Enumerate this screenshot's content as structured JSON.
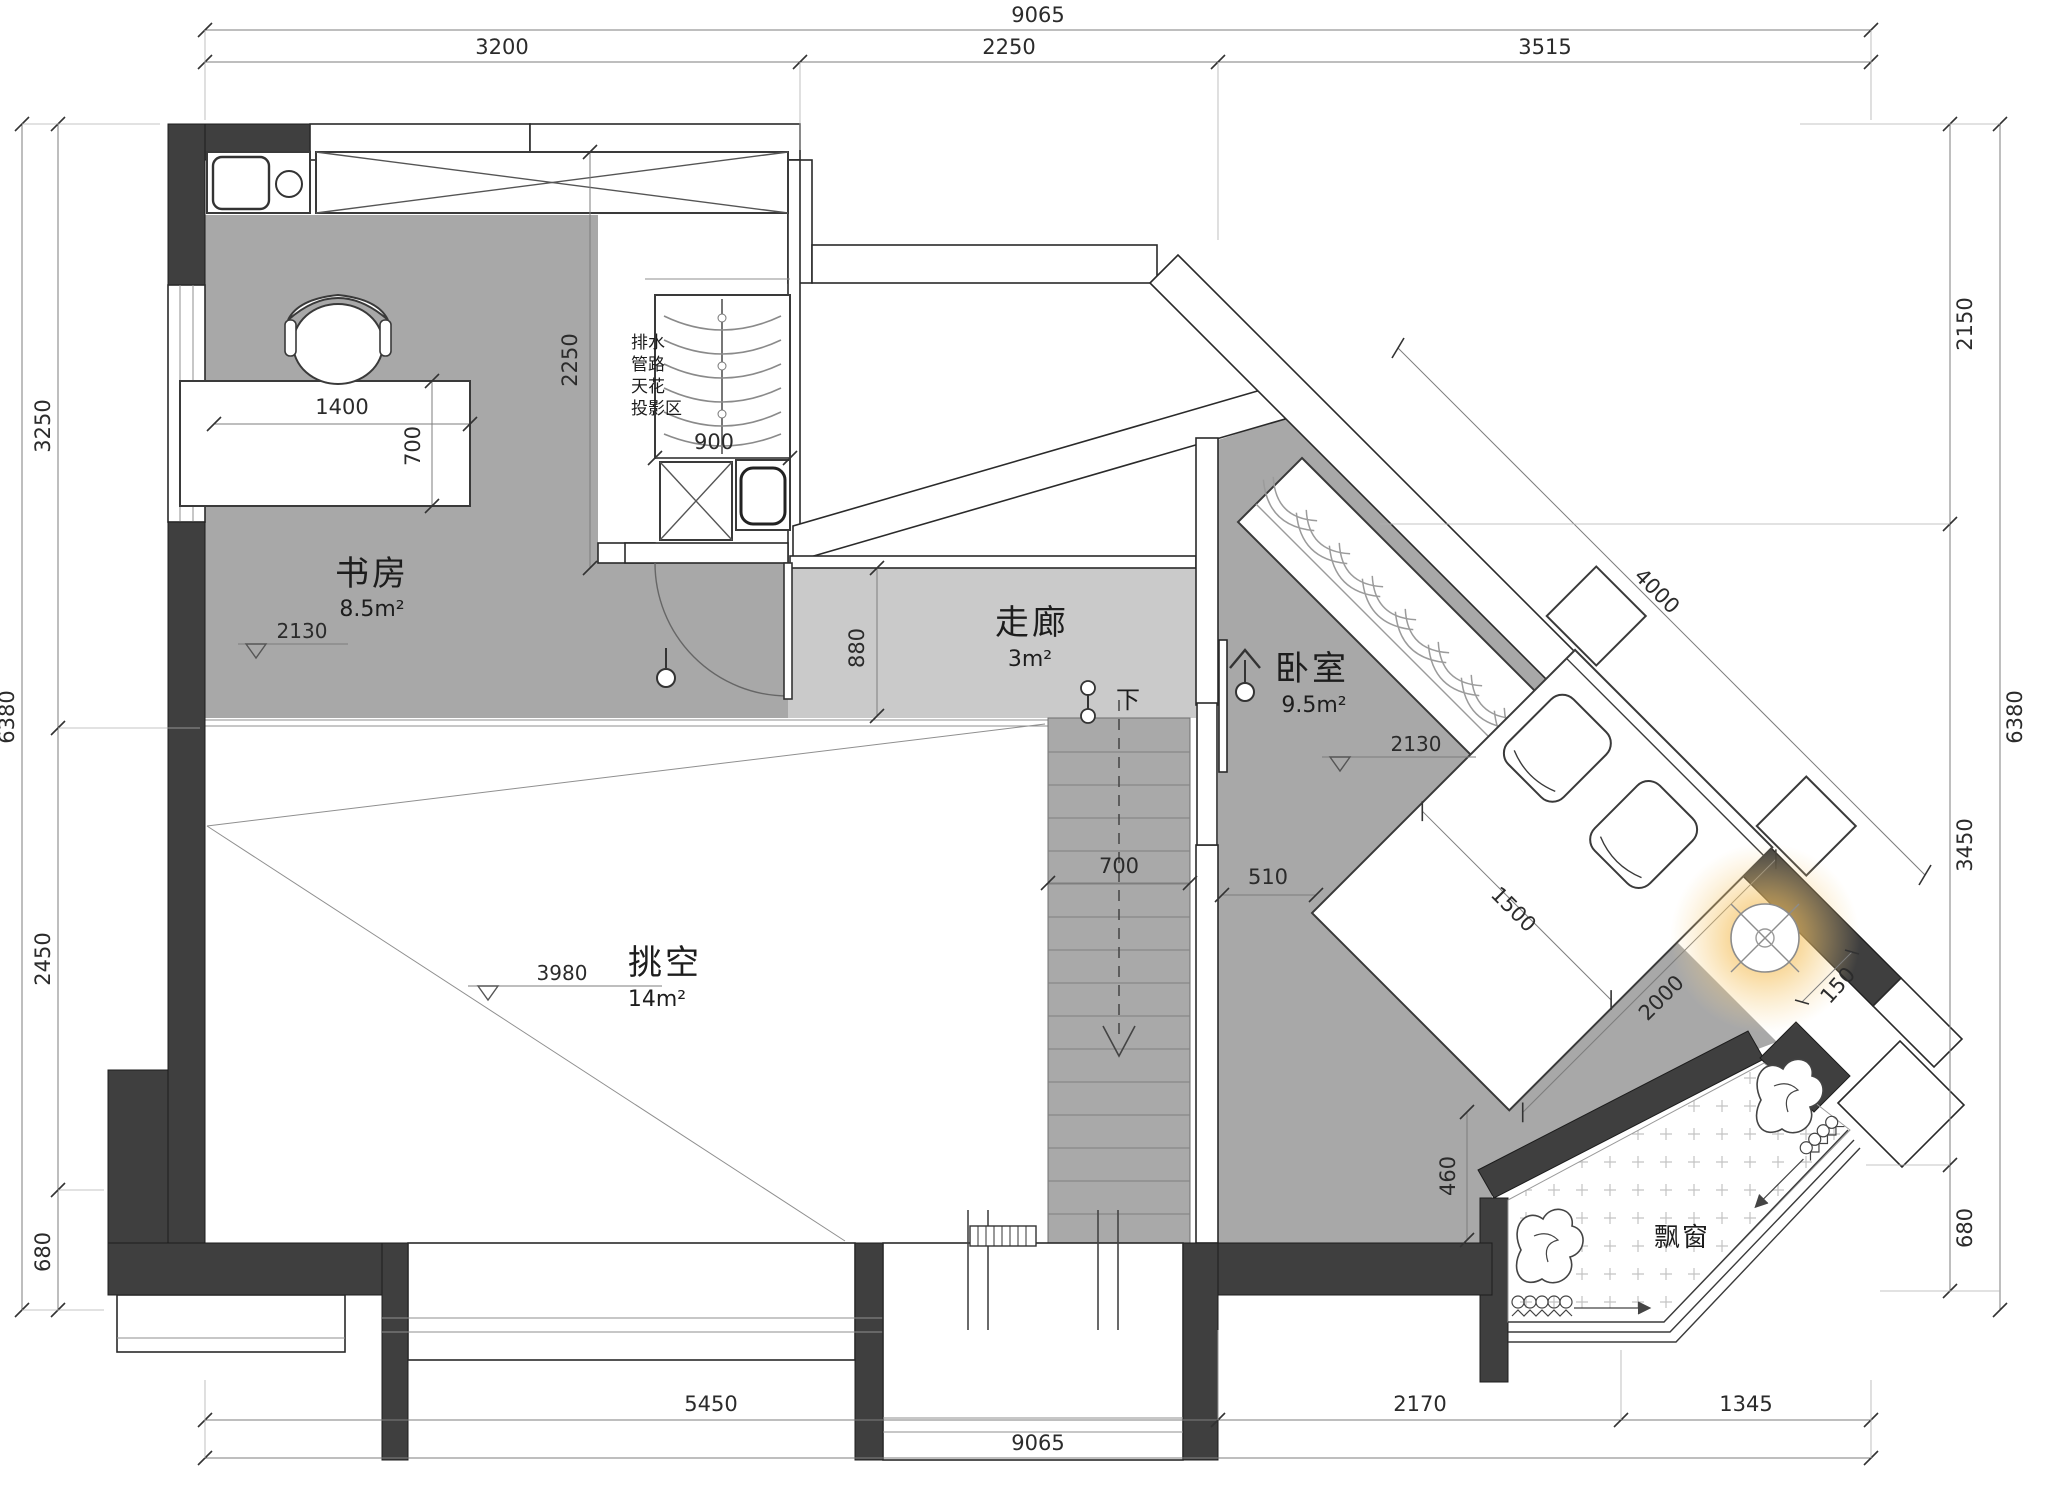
{
  "rooms": {
    "study": {
      "name": "书房",
      "area": "8.5m²",
      "level": "2130"
    },
    "corridor": {
      "name": "走廊",
      "area": "3m²"
    },
    "bedroom": {
      "name": "卧室",
      "area": "9.5m²",
      "level": "2130"
    },
    "void": {
      "name": "挑空",
      "area": "14m²",
      "level": "3980"
    },
    "bay_window": {
      "name": "飘窗"
    }
  },
  "annotations": {
    "ceiling_note": [
      "排水",
      "管路",
      "天花",
      "投影区"
    ],
    "stair_down": "下"
  },
  "dimensions": {
    "top": {
      "total": "9065",
      "segments": [
        "3200",
        "2250",
        "3515"
      ]
    },
    "bottom": {
      "total": "9065",
      "segments": [
        "5450",
        "2170",
        "1345"
      ]
    },
    "left": {
      "total": "6380",
      "segments": [
        "3250",
        "2450",
        "680"
      ]
    },
    "right": {
      "total": "6380",
      "segments": [
        "2150",
        "3450",
        "680"
      ]
    },
    "diagonal_wall": "4000",
    "interior": {
      "desk_width": "1400",
      "desk_depth": "700",
      "pipe_zone_depth": "2250",
      "wardrobe_width": "900",
      "corridor_width": "880",
      "stair_width": "700",
      "door_offset": "510",
      "bed_width": "1500",
      "bed_length": "2000",
      "bed_clearance": "460",
      "lamp_offset": "150"
    }
  },
  "colors": {
    "wall": "#3f3f3f",
    "floor_dark": "#a8a8a8",
    "floor_light": "#cacaca",
    "lamp_glow": "#f2b24a"
  }
}
